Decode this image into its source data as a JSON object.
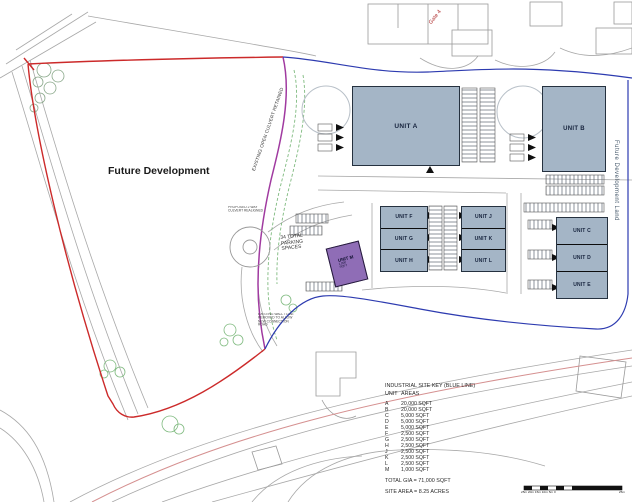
{
  "labels": {
    "future_development": "Future Development",
    "future_development_land": "Future Development Land",
    "existing_culvert": "EXISTING OPEN CULVERT RETAINED",
    "gate": "Gate 4",
    "parking_spaces_note": "34 TOTAL PARKING SPACES",
    "culvert_note_line1": "PROPOSED 2 WAY",
    "culvert_note_line2": "CULVERT REALIGNED",
    "wall_note_line1": "EXISTING WALL TO BE",
    "wall_note_line2": "REMOVED TO ALLOW",
    "wall_note_line3": "NEW CONNECTION",
    "wall_note_line4": "ROAD"
  },
  "units": [
    {
      "id": "A",
      "label": "UNIT A",
      "area": "20,000 SQFT"
    },
    {
      "id": "B",
      "label": "UNIT B",
      "area": "20,000 SQFT"
    },
    {
      "id": "C",
      "label": "UNIT C",
      "area": "5,000 SQFT"
    },
    {
      "id": "D",
      "label": "UNIT D",
      "area": "5,000 SQFT"
    },
    {
      "id": "E",
      "label": "UNIT E",
      "area": "5,000 SQFT"
    },
    {
      "id": "F",
      "label": "UNIT F",
      "area": "2,500 SQFT"
    },
    {
      "id": "G",
      "label": "UNIT G",
      "area": "2,500 SQFT"
    },
    {
      "id": "H",
      "label": "UNIT H",
      "area": "2,500 SQFT"
    },
    {
      "id": "J",
      "label": "UNIT J",
      "area": "2,500 SQFT"
    },
    {
      "id": "K",
      "label": "UNIT K",
      "area": "2,500 SQFT"
    },
    {
      "id": "L",
      "label": "UNIT L",
      "area": "2,500 SQFT"
    },
    {
      "id": "M",
      "label": "UNIT M",
      "area": "1,000 SQFT"
    }
  ],
  "legend": {
    "title": "INDUSTRIAL SITE KEY (BLUE LINE)",
    "columns": {
      "unit": "UNIT",
      "areas": "AREAS"
    },
    "total": "TOTAL GIA = 71,000 SQFT",
    "site_area": "SITE AREA = 8.25 ACRES"
  },
  "scale_bar": {
    "left_labels": "25m 20m 15m 10m 5m 0",
    "right_label": "25m"
  },
  "colors": {
    "unit_fill": "#a4b5c6",
    "unit_m_fill": "#8f6db6",
    "boundary_red": "#cc2a2a",
    "boundary_blue": "#2d3bb0",
    "culvert_purple": "#a03aa0",
    "tree_green": "#7fba7f",
    "road_gray": "#a8a8a8",
    "road_pink": "#d59090"
  }
}
